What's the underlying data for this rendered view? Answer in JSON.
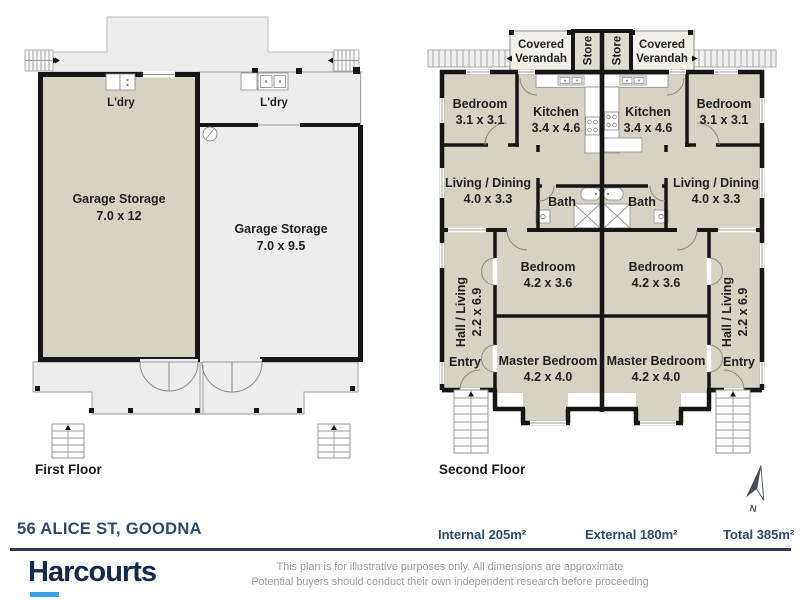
{
  "colors": {
    "brand_navy": "#14294e",
    "brand_blue": "#36a3e2",
    "text_navy": "#2e4a66",
    "room_fill": "#d6d3c5",
    "open_area_fill": "#ededed",
    "wall": "#161616"
  },
  "first_floor": {
    "label": "First Floor",
    "ldry": "L'dry",
    "garage_left": {
      "name": "Garage Storage",
      "dims": "7.0 x 12"
    },
    "garage_right": {
      "name": "Garage Storage",
      "dims": "7.0 x 9.5"
    }
  },
  "second_floor": {
    "label": "Second Floor",
    "covered_verandah": {
      "line1": "Covered",
      "line2": "Verandah"
    },
    "store": "Store",
    "bedroom_front": {
      "name": "Bedroom",
      "dims": "3.1 x 3.1"
    },
    "kitchen": {
      "name": "Kitchen",
      "dims": "3.4 x 4.6"
    },
    "living": {
      "name": "Living / Dining",
      "dims": "4.0 x 3.3"
    },
    "bath": "Bath",
    "bedroom_mid": {
      "name": "Bedroom",
      "dims": "4.2 x 3.6"
    },
    "master": {
      "name": "Master Bedroom",
      "dims": "4.2 x 4.0"
    },
    "hall": {
      "name": "Hall / Living",
      "dims": "2.2 x 6.9"
    },
    "entry": "Entry",
    "north": "N"
  },
  "footer": {
    "address": "56 ALICE ST, GOODNA",
    "internal": "Internal 205m²",
    "external": "External 180m²",
    "total": "Total 385m²",
    "brand": "Harcourts",
    "disclaimer1": "This plan is for illustrative purposes only. All dimensions are approximate",
    "disclaimer2": "Potential buyers should conduct their own independent research before proceeding"
  }
}
